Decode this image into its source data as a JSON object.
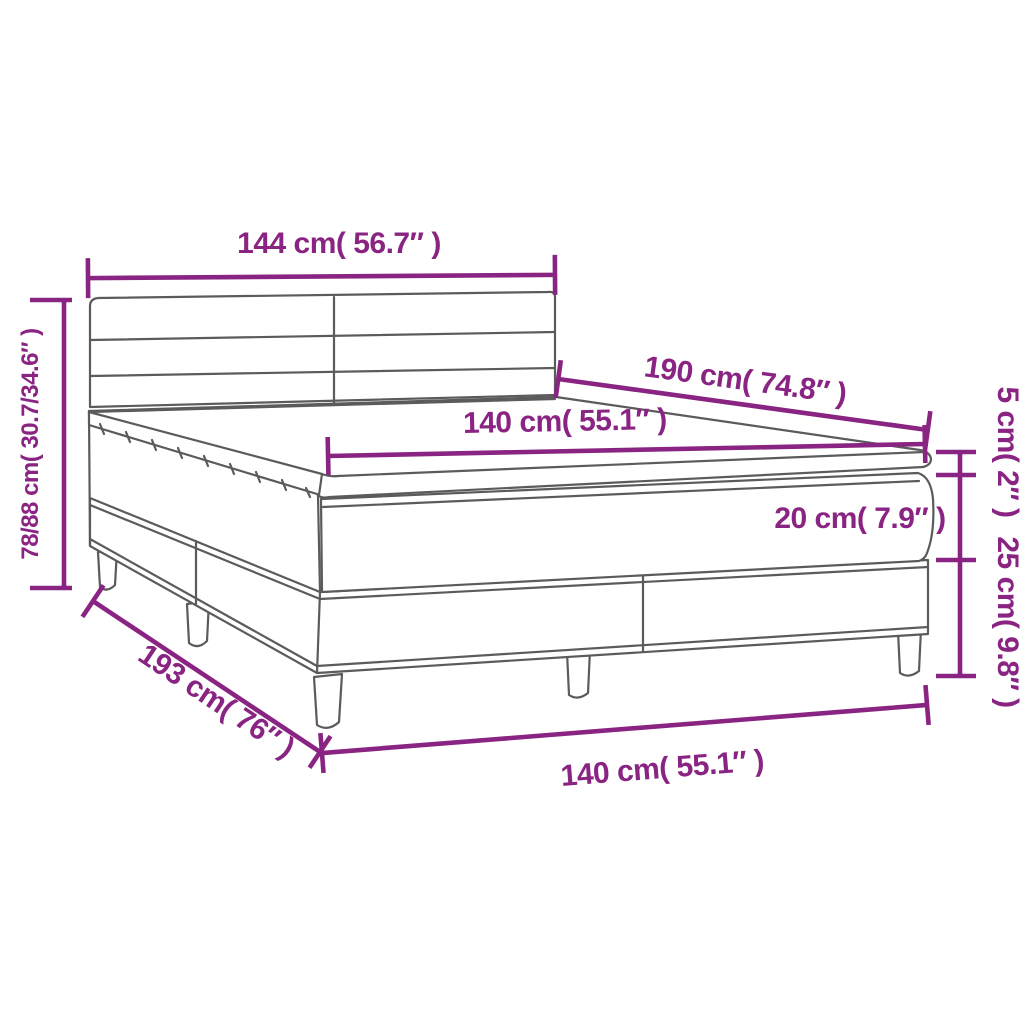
{
  "diagram": {
    "name": "box-spring-bed-dimension-diagram",
    "colors": {
      "dimension_accent": "#8A2482",
      "bed_outline": "#5B5B5B",
      "background": "#FFFFFF"
    },
    "labels": {
      "headboard_width": "144 cm( 56.7″ )",
      "headboard_height": "78/88 cm( 30.7/34.6″ )",
      "mattress_length": "190 cm( 74.8″ )",
      "mattress_width_top": "140 cm( 55.1″ )",
      "topper_height": "5 cm( 2″ )",
      "mattress_height": "20 cm( 7.9″ )",
      "base_height": "25 cm( 9.8″ )",
      "frame_length": "193 cm( 76″ )",
      "frame_width_bottom": "140 cm( 55.1″ )"
    }
  }
}
